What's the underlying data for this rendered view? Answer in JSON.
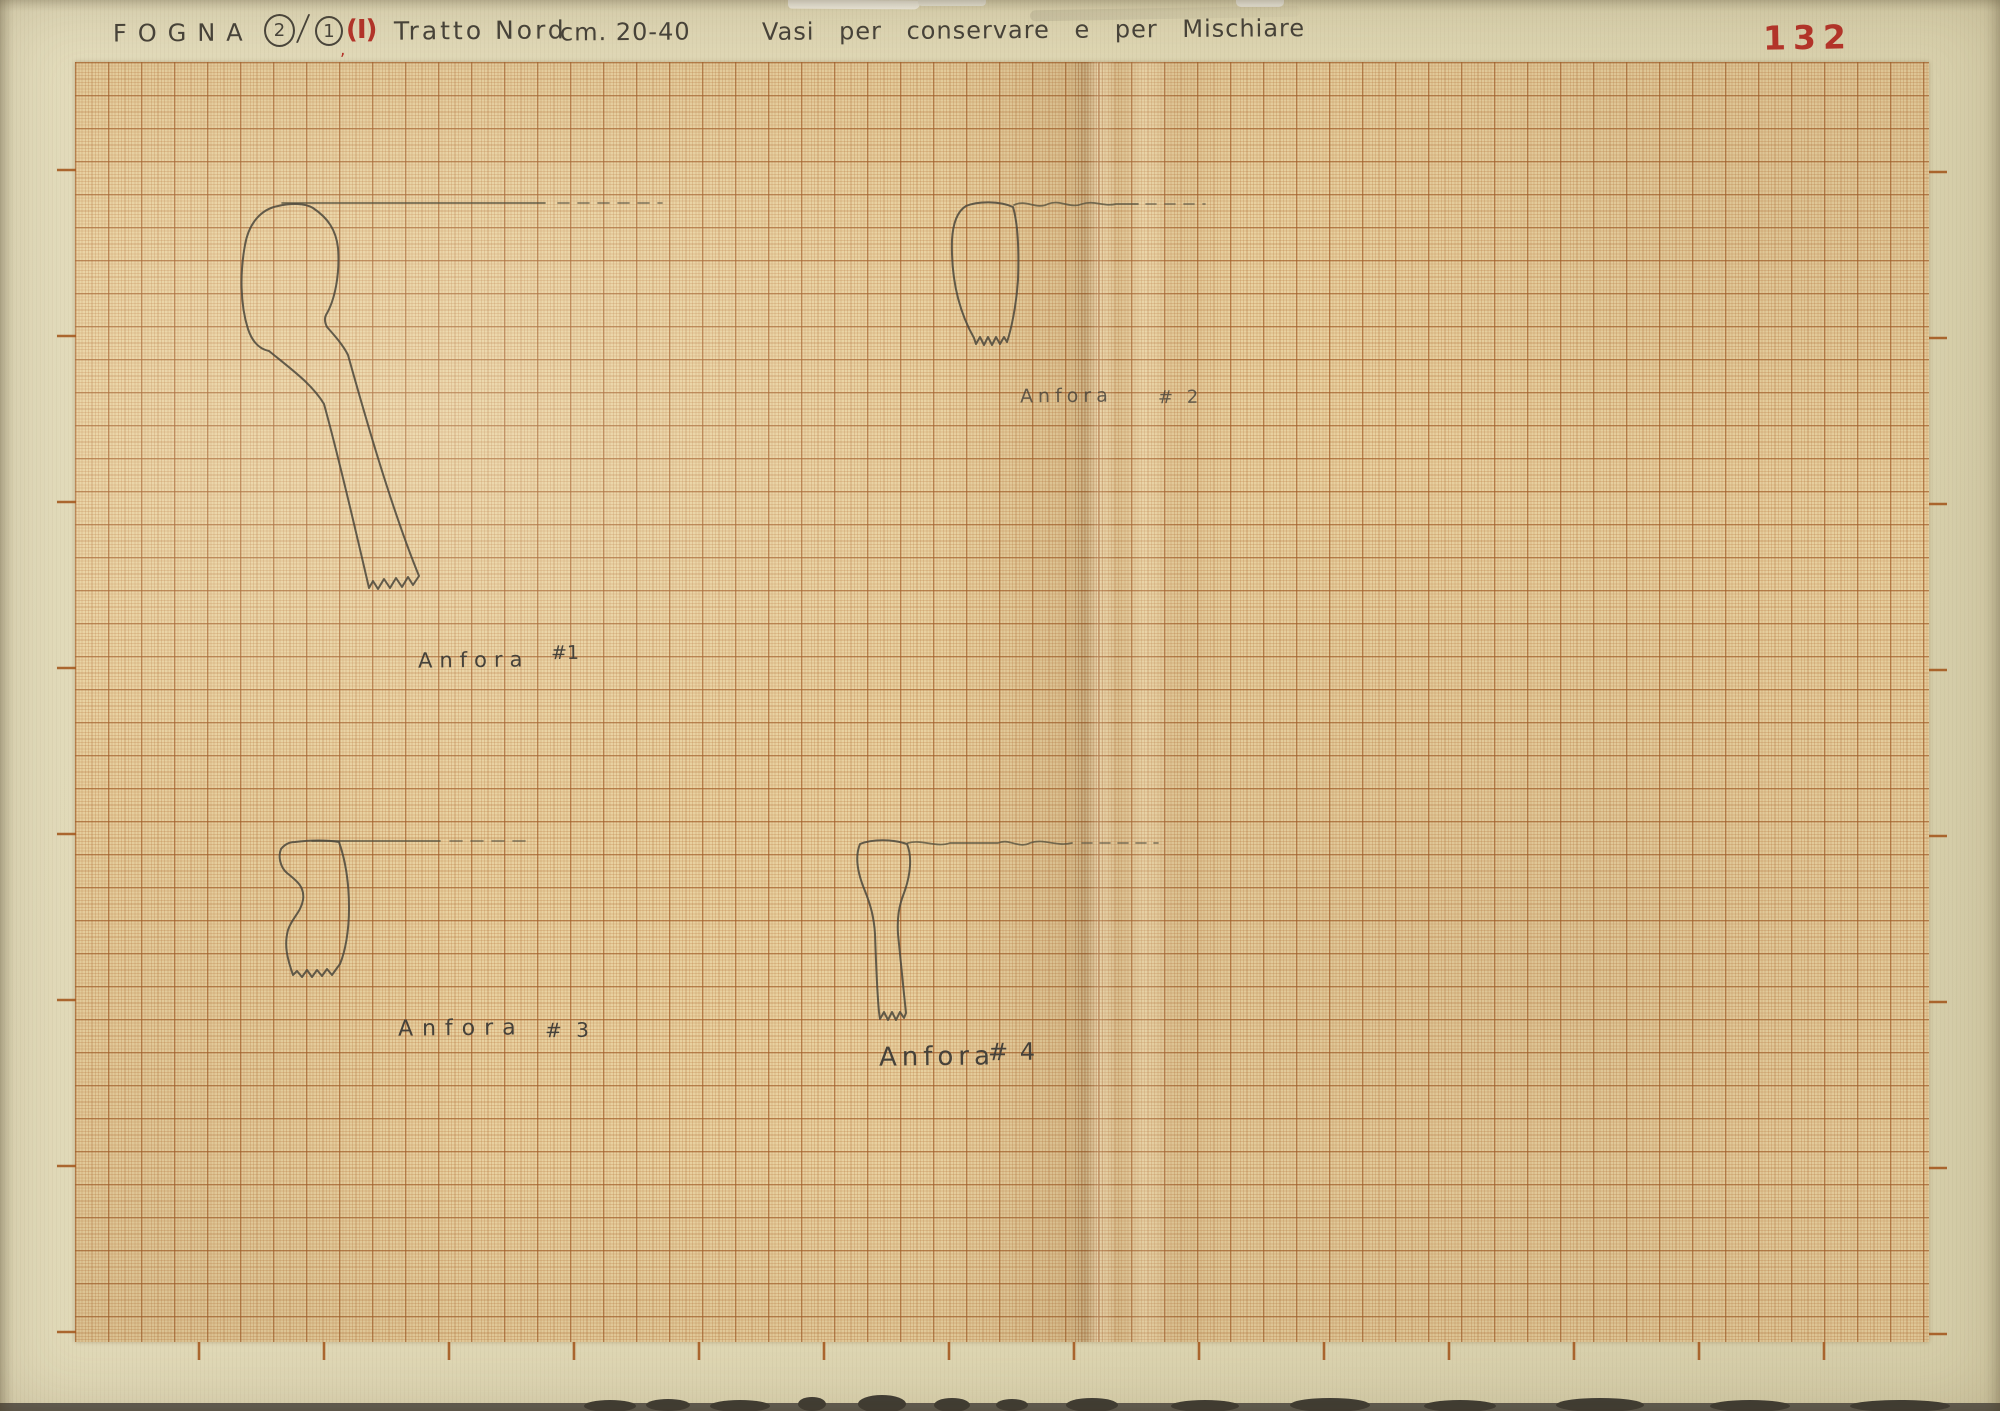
{
  "page": {
    "page_number": "132",
    "title": {
      "site": "FOGNA",
      "num_primary": "2",
      "slash": "/",
      "num_secondary": "1",
      "comma": ",",
      "roman": "(I)",
      "section": "Tratto Nord",
      "depth": "cm. 20-40",
      "description": "Vasi per conservare e per Mischiare"
    }
  },
  "figures": [
    {
      "label": "Anfora",
      "number": "#1"
    },
    {
      "label": "Anfora",
      "number": "# 2"
    },
    {
      "label": "Anfora",
      "number": "# 3"
    },
    {
      "label": "Anfora",
      "number": "# 4"
    }
  ],
  "colors": {
    "backing_paper": "#e0d8b6",
    "graph_paper": "#e8d1a0",
    "grid_heavy": "#a05c28",
    "grid_fine": "#c88a54",
    "pencil": "#4f4a3e",
    "red_ink": "#b5342a"
  }
}
